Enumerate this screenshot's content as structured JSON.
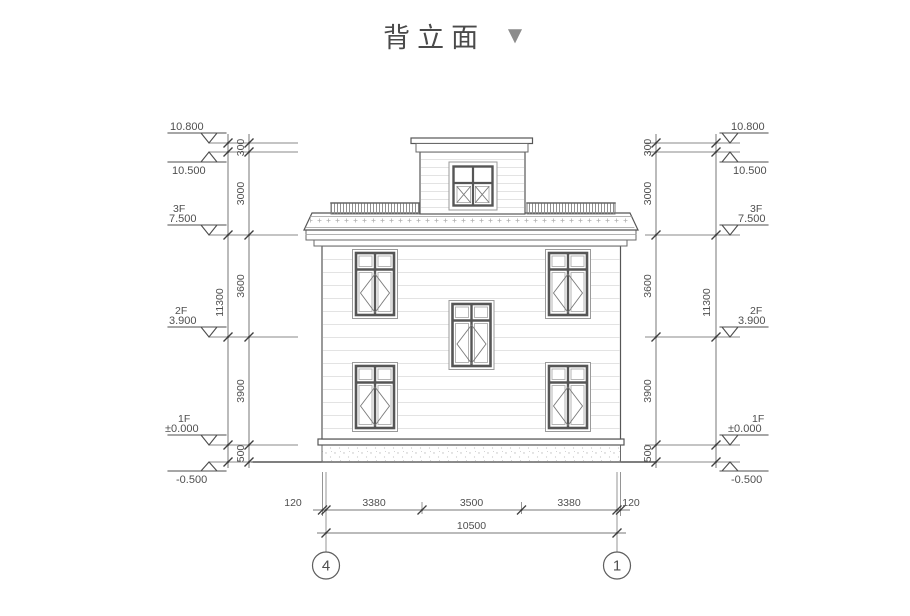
{
  "title": {
    "text": "背立面",
    "collapse_icon": "▼"
  },
  "markers_left": [
    {
      "floor": "",
      "value": "10.800"
    },
    {
      "floor": "",
      "value": "10.500"
    },
    {
      "floor": "3F",
      "value": "7.500"
    },
    {
      "floor": "2F",
      "value": "3.900"
    },
    {
      "floor": "1F",
      "value": "±0.000"
    },
    {
      "floor": "",
      "value": "-0.500"
    }
  ],
  "markers_right": [
    {
      "floor": "",
      "value": "10.800"
    },
    {
      "floor": "",
      "value": "10.500"
    },
    {
      "floor": "3F",
      "value": "7.500"
    },
    {
      "floor": "2F",
      "value": "3.900"
    },
    {
      "floor": "1F",
      "value": "±0.000"
    },
    {
      "floor": "",
      "value": "-0.500"
    }
  ],
  "dims_left": {
    "segments": [
      "300",
      "3000",
      "3600",
      "3900",
      "500"
    ],
    "total": "11300"
  },
  "dims_right": {
    "segments": [
      "300",
      "3000",
      "3600",
      "3900",
      "500"
    ],
    "total": "11300"
  },
  "dims_bottom": {
    "segments": [
      "120",
      "3380",
      "3500",
      "3380",
      "120"
    ],
    "total": "10500"
  },
  "axes": {
    "left": "4",
    "right": "1"
  },
  "colors": {
    "background": "#ffffff",
    "drawing_line": "#555555",
    "dimension_line": "#777777",
    "dimension_text": "#4f4f4f",
    "title_text": "#4a4a4a",
    "collapse_arrow": "#8c8c8c",
    "siding_line": "#e3e3e3",
    "railing_hatch": "#8f8f8f"
  }
}
